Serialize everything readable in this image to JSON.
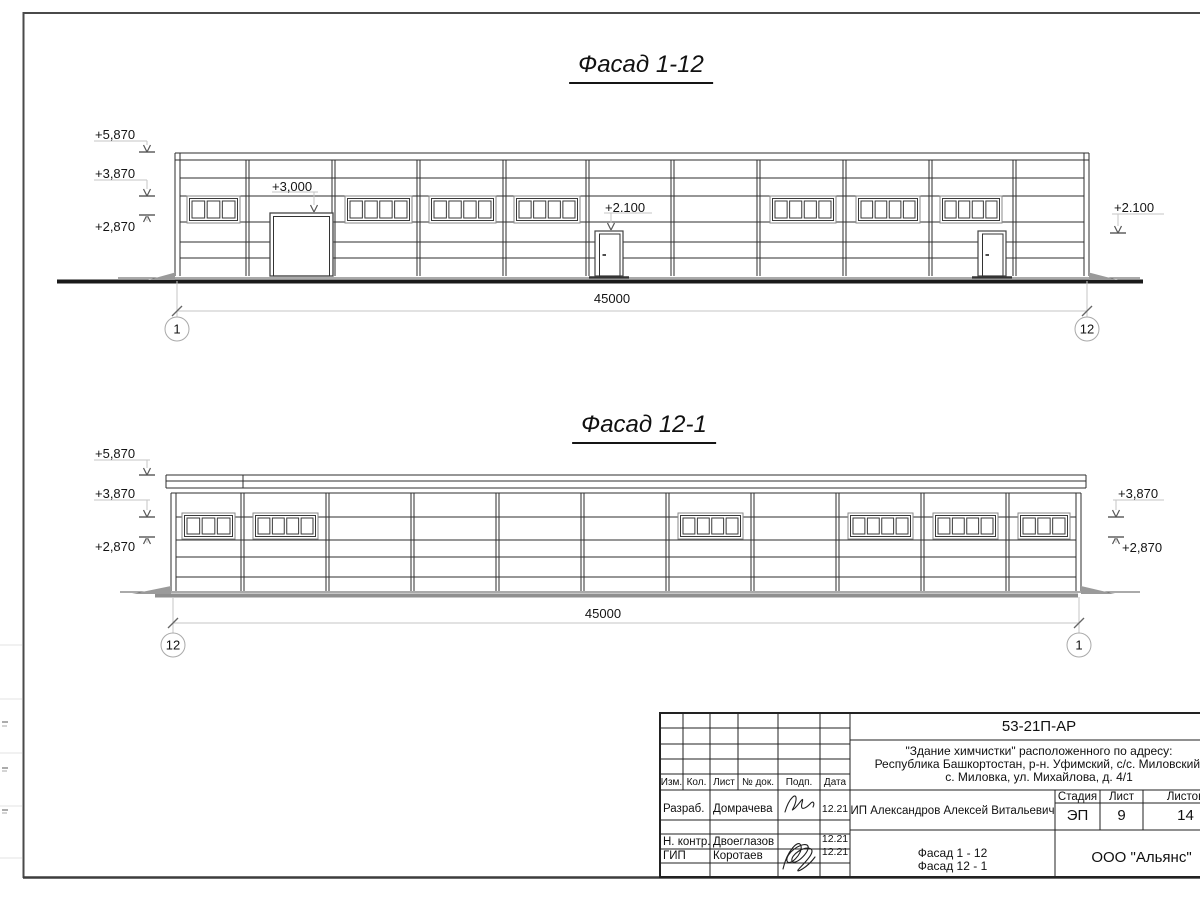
{
  "drawing": {
    "facade_top": {
      "title": "Фасад 1-12",
      "marks": [
        "+5,870",
        "+3,870",
        "+2,870"
      ],
      "gate_mark": "+3,000",
      "door_mark": "+2.100",
      "right_mark": "+2.100",
      "dimension": "45000",
      "axis_left": "1",
      "axis_right": "12"
    },
    "facade_bottom": {
      "title": "Фасад 12-1",
      "marks": [
        "+5,870",
        "+3,870",
        "+2,870"
      ],
      "marks_right": [
        "+3,870",
        "+2,870"
      ],
      "dimension": "45000",
      "axis_left": "12",
      "axis_right": "1"
    }
  },
  "title_block": {
    "code": "53-21П-АР",
    "project_lines": [
      "\"Здание химчистки\" расположенного по адресу:",
      "Республика Башкортостан, р-н. Уфимский, с/с. Миловский,",
      "с. Миловка, ул. Михайлова, д. 4/1"
    ],
    "rev_headers": [
      "Изм.",
      "Кол.",
      "Лист",
      "№ док.",
      "Подп.",
      "Дата"
    ],
    "rows": [
      {
        "role": "Разраб.",
        "name": "Домрачева",
        "date": "12.21"
      },
      {
        "role": "Н. контр.",
        "name": "Двоеглазов",
        "date": "12.21"
      },
      {
        "role": "ГИП",
        "name": "Коротаев",
        "date": "12.21"
      }
    ],
    "client": "ИП Александров Алексей Витальевич",
    "stage_label": "Стадия",
    "sheet_label": "Лист",
    "sheets_label": "Листов",
    "stage": "ЭП",
    "sheet": "9",
    "sheets": "14",
    "doc_lines": [
      "Фасад 1 - 12",
      "Фасад 12 - 1"
    ],
    "company": "ООО \"Альянс\""
  }
}
